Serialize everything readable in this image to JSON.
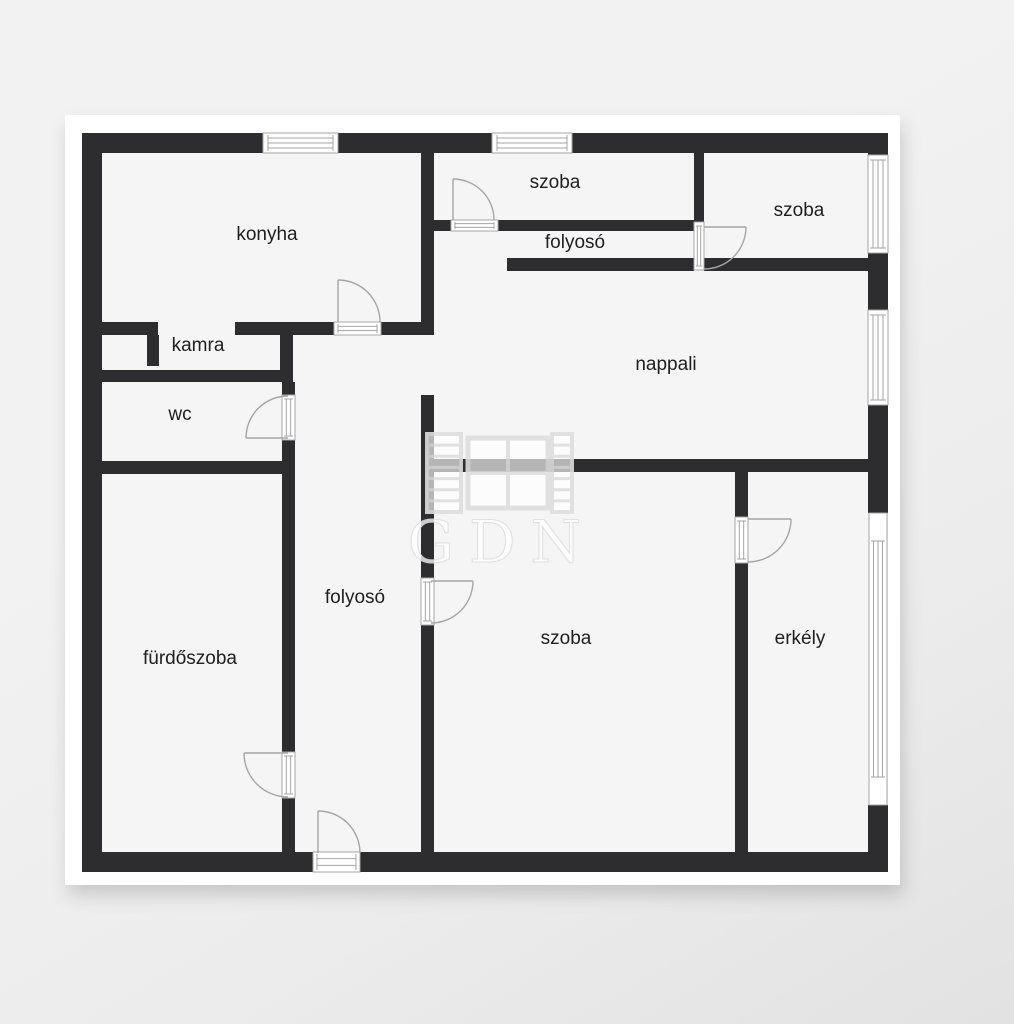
{
  "title": "apartment floor plan",
  "watermark": {
    "text": "GDN"
  },
  "colors": {
    "page_bg": "#f0f0f0",
    "card": "#ffffff",
    "floor": "#f5f5f6",
    "wall": "#2d2d2f",
    "line": "#a5a5a5",
    "label": "#1e1e1e",
    "watermark_stroke": "#dedede",
    "watermark_fill": "rgba(255,255,255,0.72)",
    "watermark_text_fill": "rgba(255,255,255,0.85)"
  },
  "plan": {
    "card": {
      "x": 65,
      "y": 115,
      "w": 835,
      "h": 770
    },
    "floor": {
      "x": 82,
      "y": 133,
      "w": 806,
      "h": 739
    },
    "rooms": [
      {
        "label": "konyha",
        "x": 267,
        "y": 233
      },
      {
        "label": "szoba",
        "x": 555,
        "y": 181
      },
      {
        "label": "folyosó",
        "x": 575,
        "y": 241
      },
      {
        "label": "szoba",
        "x": 799,
        "y": 209
      },
      {
        "label": "nappali",
        "x": 666,
        "y": 363
      },
      {
        "label": "kamra",
        "x": 198,
        "y": 344
      },
      {
        "label": "wc",
        "x": 180,
        "y": 413
      },
      {
        "label": "fürdőszoba",
        "x": 190,
        "y": 657
      },
      {
        "label": "folyosó",
        "x": 355,
        "y": 596
      },
      {
        "label": "szoba",
        "x": 566,
        "y": 637
      },
      {
        "label": "erkély",
        "x": 800,
        "y": 637
      }
    ],
    "walls": [
      [
        82,
        133,
        181,
        20
      ],
      [
        338,
        133,
        154,
        20
      ],
      [
        572,
        133,
        316,
        20
      ],
      [
        82,
        133,
        20,
        739
      ],
      [
        82,
        852,
        231,
        20
      ],
      [
        360,
        852,
        528,
        20
      ],
      [
        868,
        133,
        20,
        22
      ],
      [
        868,
        253,
        20,
        57
      ],
      [
        868,
        405,
        20,
        108
      ],
      [
        868,
        805,
        20,
        67
      ],
      [
        421,
        153,
        13,
        182
      ],
      [
        100,
        322,
        58,
        13
      ],
      [
        235,
        322,
        99,
        13
      ],
      [
        381,
        322,
        53,
        13
      ],
      [
        280,
        335,
        13,
        37
      ],
      [
        147,
        335,
        12,
        31
      ],
      [
        100,
        370,
        193,
        12
      ],
      [
        282,
        382,
        13,
        13
      ],
      [
        282,
        440,
        13,
        312
      ],
      [
        282,
        798,
        13,
        54
      ],
      [
        100,
        461,
        182,
        13
      ],
      [
        507,
        258,
        187,
        13
      ],
      [
        704,
        258,
        164,
        13
      ],
      [
        421,
        220,
        30,
        11
      ],
      [
        498,
        220,
        196,
        11
      ],
      [
        694,
        153,
        10,
        69
      ],
      [
        421,
        395,
        13,
        183
      ],
      [
        421,
        625,
        13,
        227
      ],
      [
        421,
        459,
        447,
        13
      ],
      [
        735,
        472,
        13,
        45
      ],
      [
        735,
        563,
        13,
        289
      ]
    ],
    "windows": [
      {
        "x": 263,
        "y": 133,
        "w": 75,
        "h": 20,
        "o": "h",
        "inset": 5
      },
      {
        "x": 492,
        "y": 133,
        "w": 80,
        "h": 20,
        "o": "h",
        "inset": 5
      },
      {
        "x": 868,
        "y": 155,
        "w": 20,
        "h": 98,
        "o": "v",
        "inset": 5
      },
      {
        "x": 868,
        "y": 310,
        "w": 20,
        "h": 95,
        "o": "v",
        "inset": 5
      },
      {
        "x": 869,
        "y": 513,
        "w": 18,
        "h": 292,
        "o": "v",
        "inset": 28
      }
    ],
    "door_thresholds": [
      {
        "x": 334,
        "y": 322,
        "w": 47,
        "h": 13,
        "o": "h"
      },
      {
        "x": 451,
        "y": 220,
        "w": 47,
        "h": 11,
        "o": "h"
      },
      {
        "x": 694,
        "y": 222,
        "w": 10,
        "h": 48,
        "o": "v"
      },
      {
        "x": 282,
        "y": 395,
        "w": 13,
        "h": 45,
        "o": "v"
      },
      {
        "x": 282,
        "y": 752,
        "w": 13,
        "h": 46,
        "o": "v"
      },
      {
        "x": 421,
        "y": 578,
        "w": 13,
        "h": 47,
        "o": "v"
      },
      {
        "x": 735,
        "y": 517,
        "w": 13,
        "h": 46,
        "o": "v"
      },
      {
        "x": 313,
        "y": 852,
        "w": 47,
        "h": 20,
        "o": "h"
      }
    ],
    "door_swings": [
      {
        "hx": 338,
        "hy": 322,
        "r": 42,
        "a0": 270,
        "a1": 360,
        "sweep": 1
      },
      {
        "hx": 453,
        "hy": 220,
        "r": 41,
        "a0": 270,
        "a1": 360,
        "sweep": 1
      },
      {
        "hx": 704,
        "hy": 227,
        "r": 42,
        "a0": 0,
        "a1": 90,
        "sweep": 1
      },
      {
        "hx": 288,
        "hy": 438,
        "r": 42,
        "a0": 180,
        "a1": 270,
        "sweep": 1
      },
      {
        "hx": 288,
        "hy": 753,
        "r": 44,
        "a0": 180,
        "a1": 90,
        "sweep": 0
      },
      {
        "hx": 431,
        "hy": 581,
        "r": 42,
        "a0": 0,
        "a1": 90,
        "sweep": 1
      },
      {
        "hx": 748,
        "hy": 519,
        "r": 43,
        "a0": 0,
        "a1": 90,
        "sweep": 1
      },
      {
        "hx": 318,
        "hy": 853,
        "r": 42,
        "a0": 270,
        "a1": 360,
        "sweep": 1
      }
    ],
    "watermark_icon": {
      "x": 427,
      "y": 434,
      "w": 145,
      "h": 78,
      "text_x": 502,
      "text_y": 562
    }
  }
}
